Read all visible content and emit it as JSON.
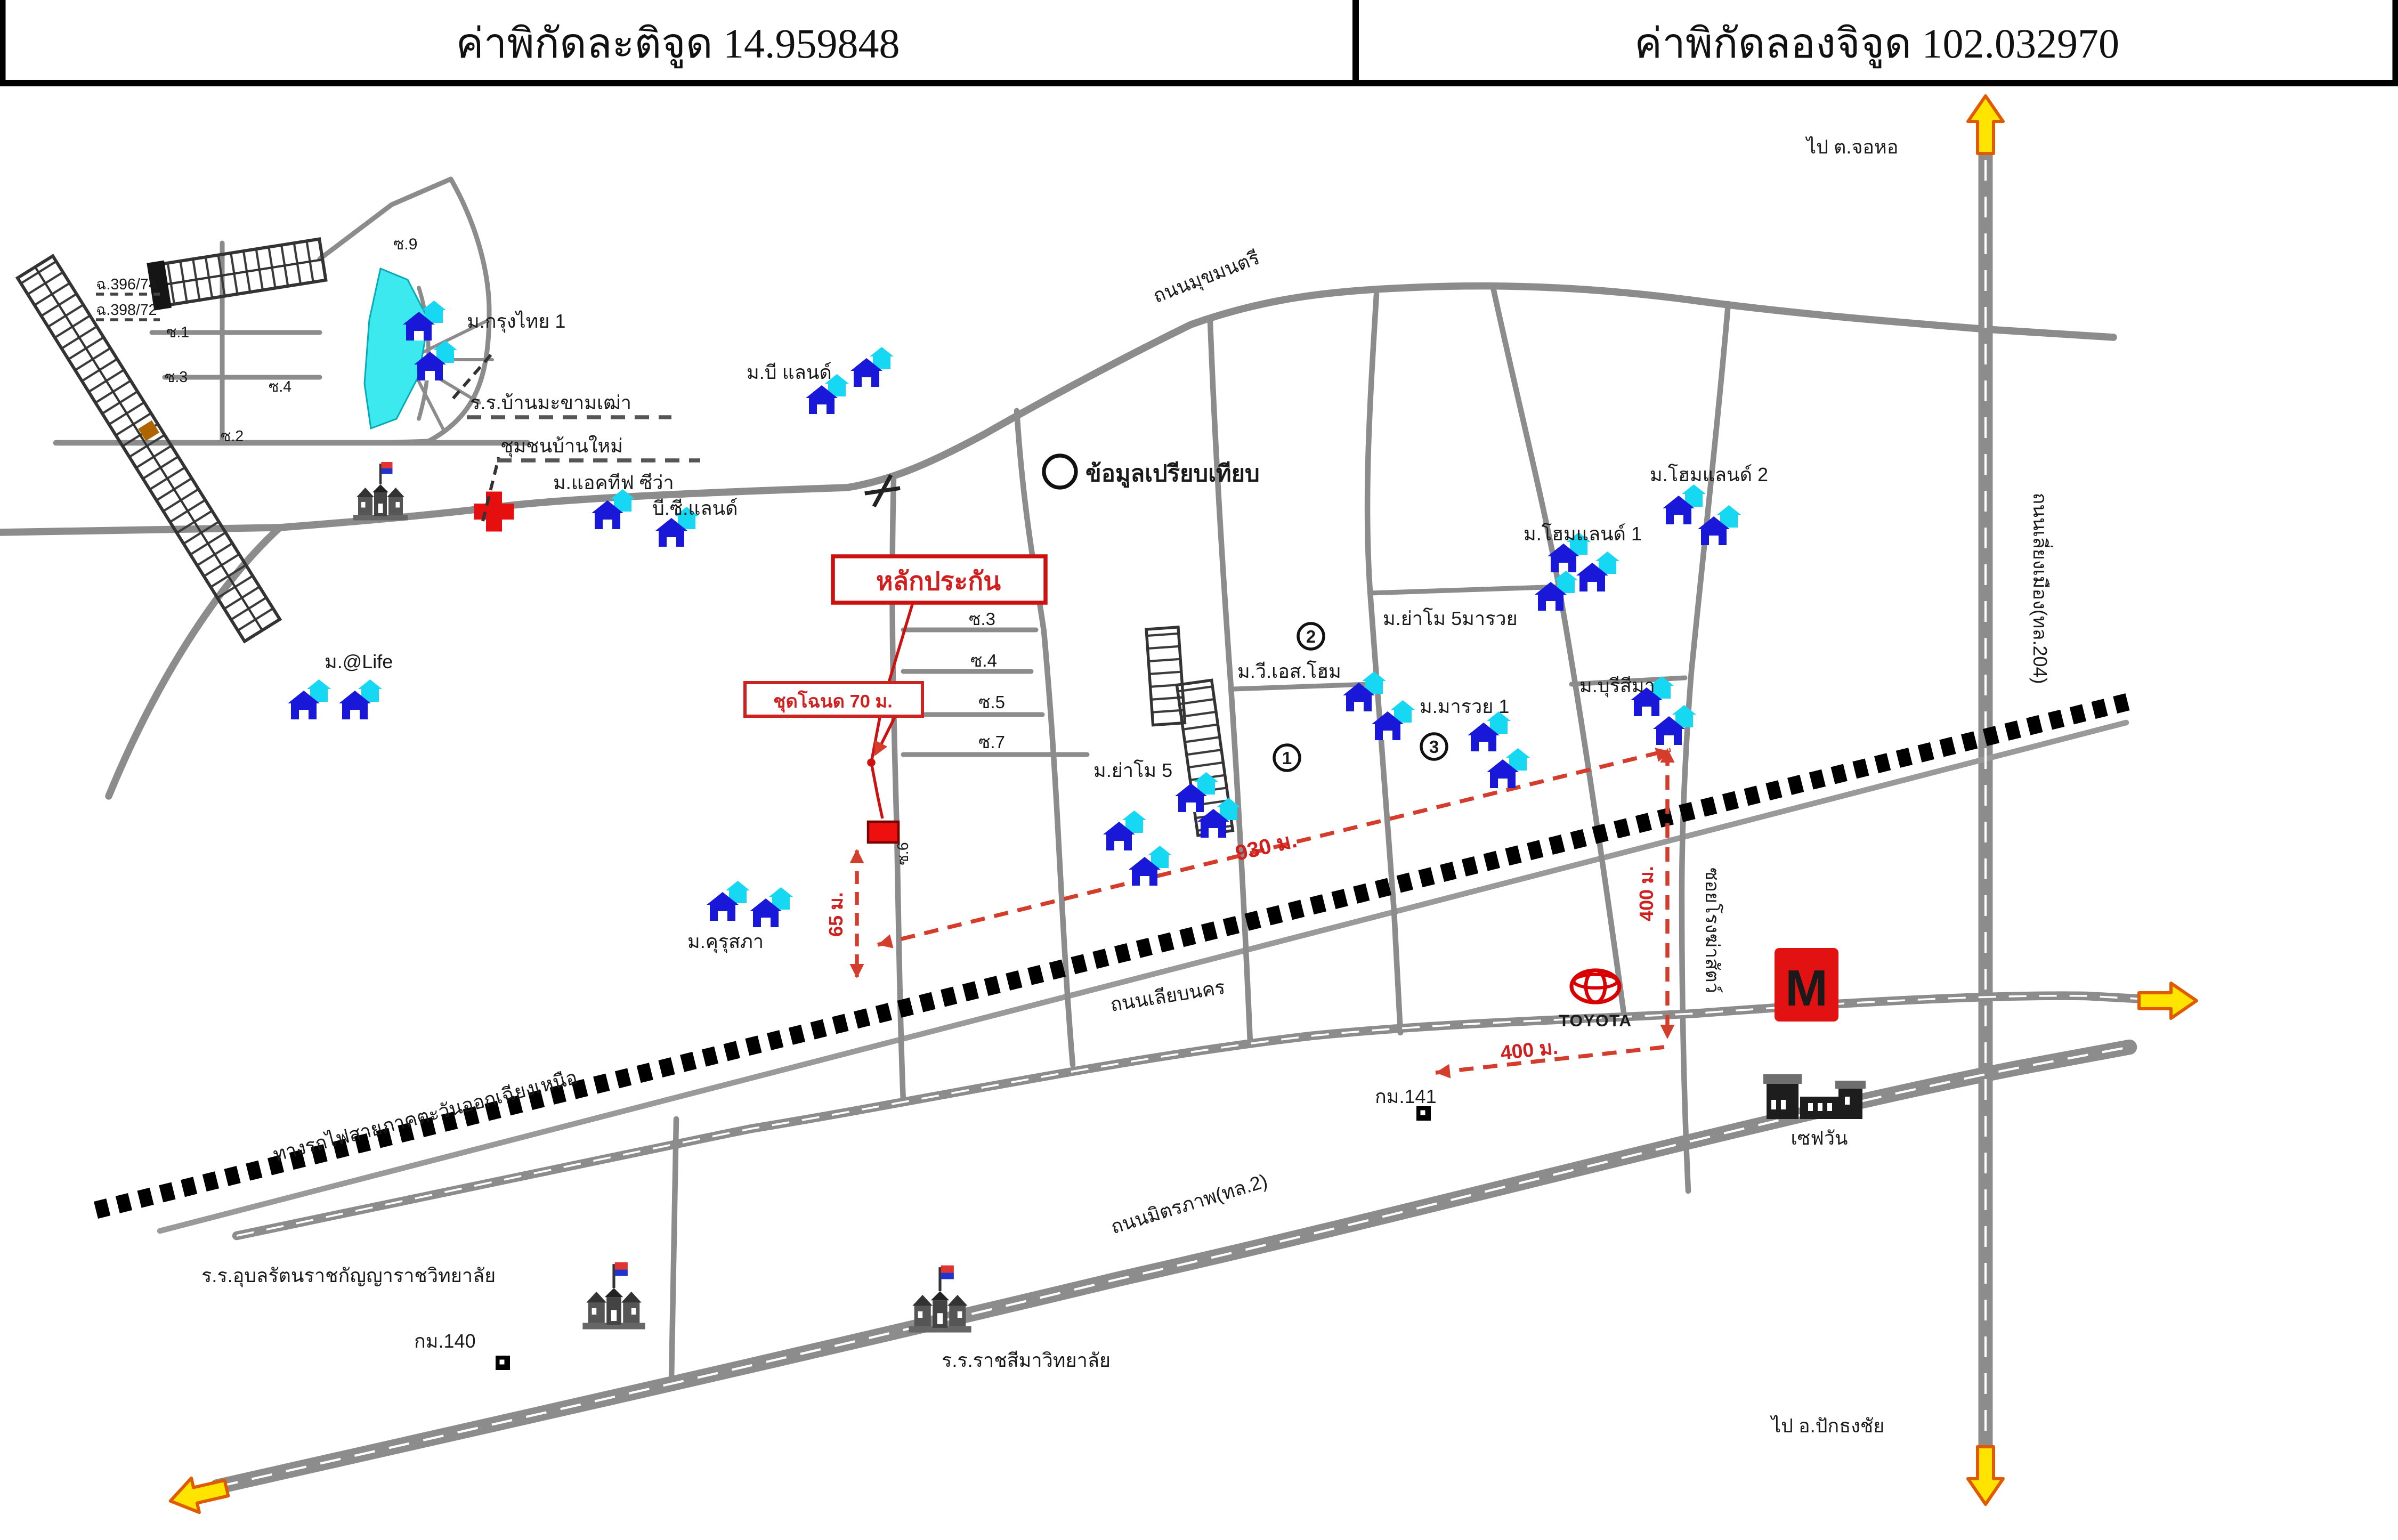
{
  "header": {
    "latitude": "ค่าพิกัดละติจูด 14.959848",
    "longitude": "ค่าพิกัดลองจิจูด 102.032970"
  },
  "colors": {
    "road": "#8c8c8c",
    "railway": "#000000",
    "accent_red": "#cf1f1f",
    "house_blue": "#1a18d8",
    "house_cyan": "#17d8f2",
    "pond_cyan": "#3ce9ee",
    "arrow_yellow": "#ffe400",
    "arrow_outline": "#e05a00"
  },
  "labels": {
    "to_johor": "ไป ต.จอหอ",
    "to_pakthongchai": "ไป อ.ปักธงชัย",
    "bypass_road": "ถนนเลี่ยงเมือง(ทล.204)",
    "mukmontri_road": "ถนนมุขมนตรี",
    "liabnakorn_road": "ถนนเลียบนคร",
    "mittraphap_road": "ถนนมิตรภาพ(ทล.2)",
    "railway": "ทางรถไฟสายภาคตะวันออกเฉียงเหนือ",
    "comparison": "ข้อมูลเปรียบเทียบ",
    "collateral": "หลักประกัน",
    "deed_note": "ชุดโฉนด 70 ม.",
    "dist_930": "930 ม.",
    "dist_65": "65 ม.",
    "dist_400_v": "400 ม.",
    "dist_400_h": "400 ม.",
    "km140": "กม.140",
    "km141": "กม.141",
    "save_one": "เซฟวัน",
    "toyota": "TOYOTA",
    "mall_m": "M",
    "school1": "ร.ร.อุบลรัตนราชกัญญาราชวิทยาลัย",
    "school2": "ร.ร.ราชสีมาวิทยาลัย",
    "soi_slaughterhouse": "ซอยโรงฆ่าสัตว์"
  },
  "villages": {
    "krungthai1": "ม.กรุงไทย 1",
    "ban_makham_thao": "ร.ร.บ้านมะขามเฒ่า",
    "chumchon_banmai": "ชุมชนบ้านใหม่",
    "active_siva": "ม.แอคทีฟ ซีว่า",
    "bc_land": "บี.ซี.แลนด์",
    "b_land": "ม.บี แลนด์",
    "at_life": "ม.@Life",
    "kurusapha": "ม.คุรุสภา",
    "yamo5": "ม.ย่าโม 5",
    "yamo5_marui": "ม.ย่าโม 5มารวย",
    "vs_home": "ม.วี.เอส.โฮม",
    "marui1": "ม.มารวย 1",
    "burisima": "ม.บุรีสีมา",
    "homeland1": "ม.โฮมแลนด์ 1",
    "homeland2": "ม.โฮมแลนด์ 2"
  },
  "sois": {
    "s1": "ซ.1",
    "s2": "ซ.2",
    "s3": "ซ.3",
    "s4": "ซ.4",
    "s5": "ซ.5",
    "s6": "ซ.6",
    "s7": "ซ.7",
    "s9": "ซ.9",
    "s3b": "ซ.3",
    "s4b": "ซ.4"
  },
  "plots": {
    "deed1": "ฉ.396/74",
    "deed2": "ฉ.398/72"
  },
  "circled": {
    "one": "1",
    "two": "2",
    "three": "3"
  }
}
